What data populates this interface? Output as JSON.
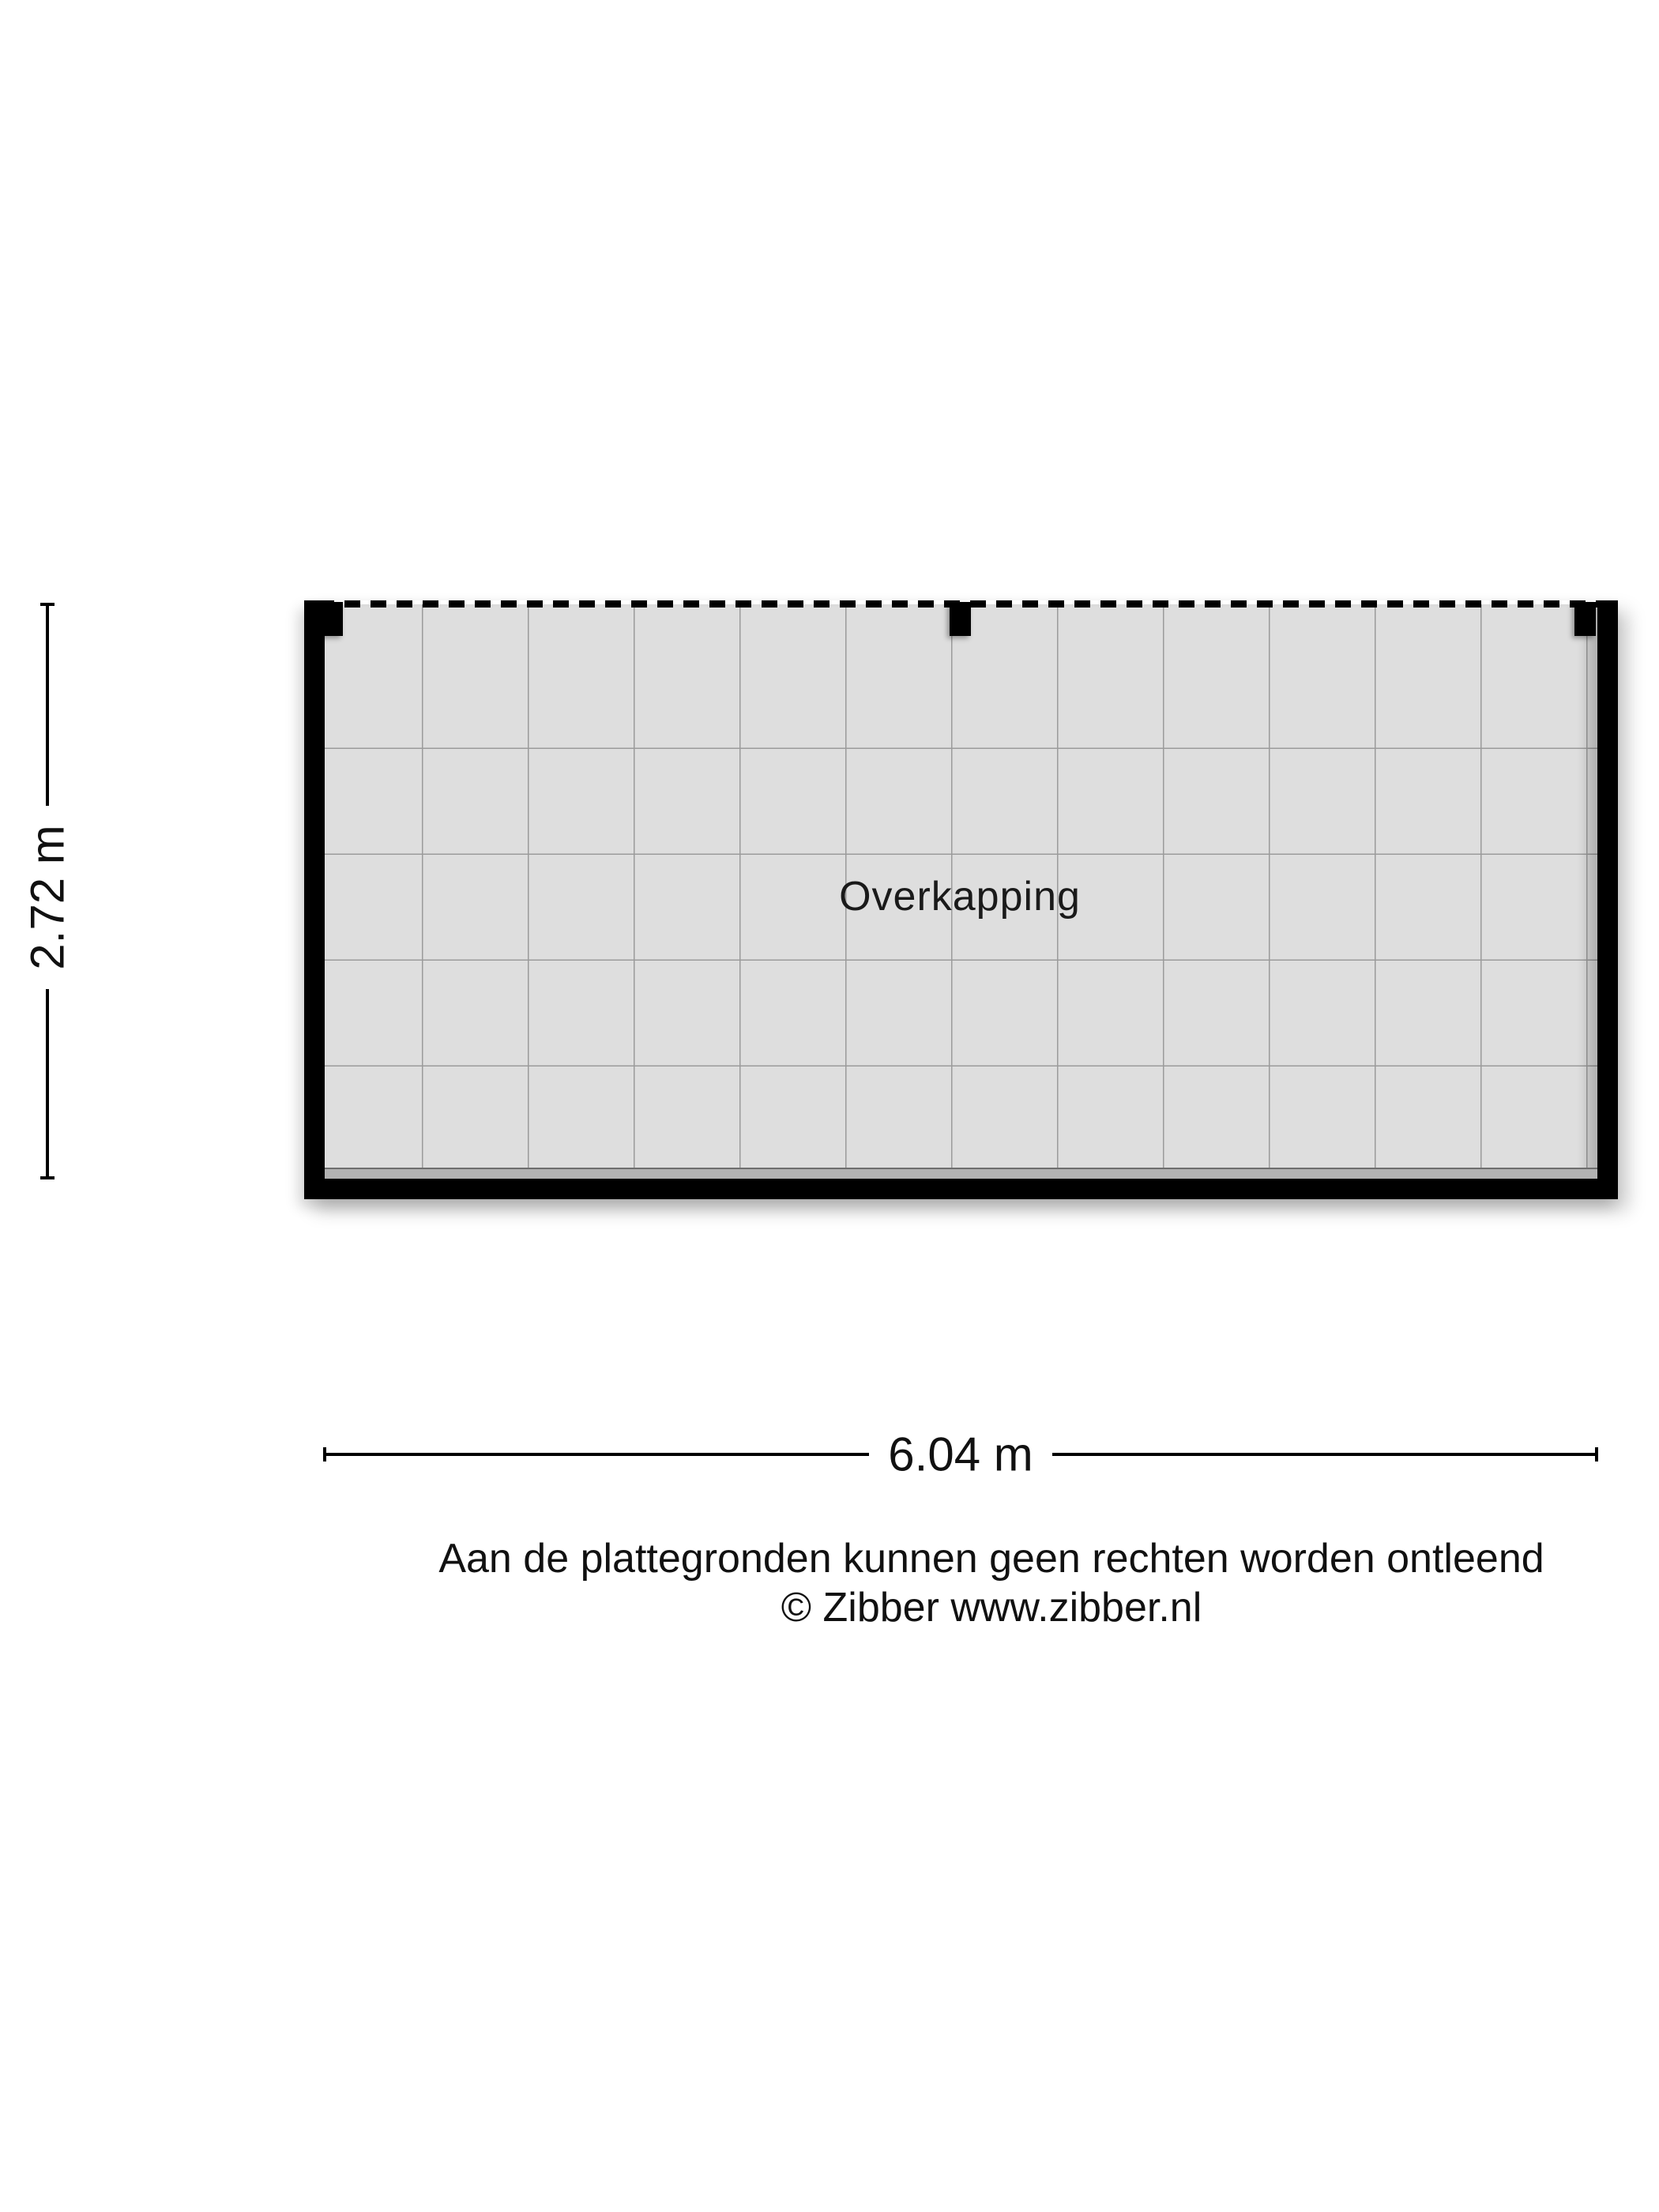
{
  "floorplan": {
    "room_label": "Overkapping",
    "width_label": "6.04 m",
    "height_label": "2.72 m"
  },
  "footer": {
    "disclaimer": "Aan de plattegronden kunnen geen rechten worden ontleend",
    "copyright": "© Zibber www.zibber.nl"
  },
  "colors": {
    "background": "#ffffff",
    "wall": "#000000",
    "floor": "#dedede",
    "grid_line": "#9b9b9b",
    "floor_edge_band": "#b2b2b2",
    "text": "#111111"
  }
}
